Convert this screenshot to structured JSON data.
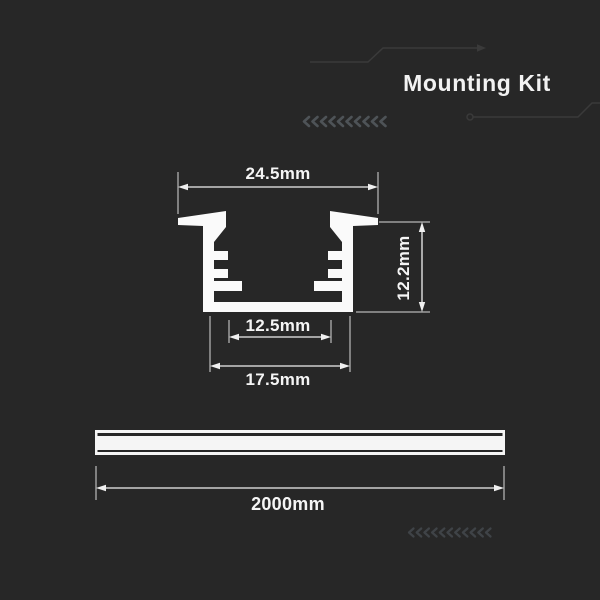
{
  "header": {
    "title": "Mounting Kit"
  },
  "diagram": {
    "cross_section": {
      "top_width": "24.5mm",
      "height": "12.2mm",
      "inner_width": "12.5mm",
      "bottom_width": "17.5mm"
    },
    "profile_length": {
      "length": "2000mm"
    }
  },
  "decorations": {
    "chevron_row_top_count": 10,
    "chevron_row_bottom_count": 11
  },
  "colors": {
    "background": "#272727",
    "profile_fill": "#fafafa",
    "dimension_line": "#f0f0f0",
    "extension_line": "#d9d9d9",
    "text": "#f5f5f5",
    "deco_line": "#3a3a3a",
    "chevron_top": "#4e5357",
    "chevron_bottom": "#3f4347"
  }
}
